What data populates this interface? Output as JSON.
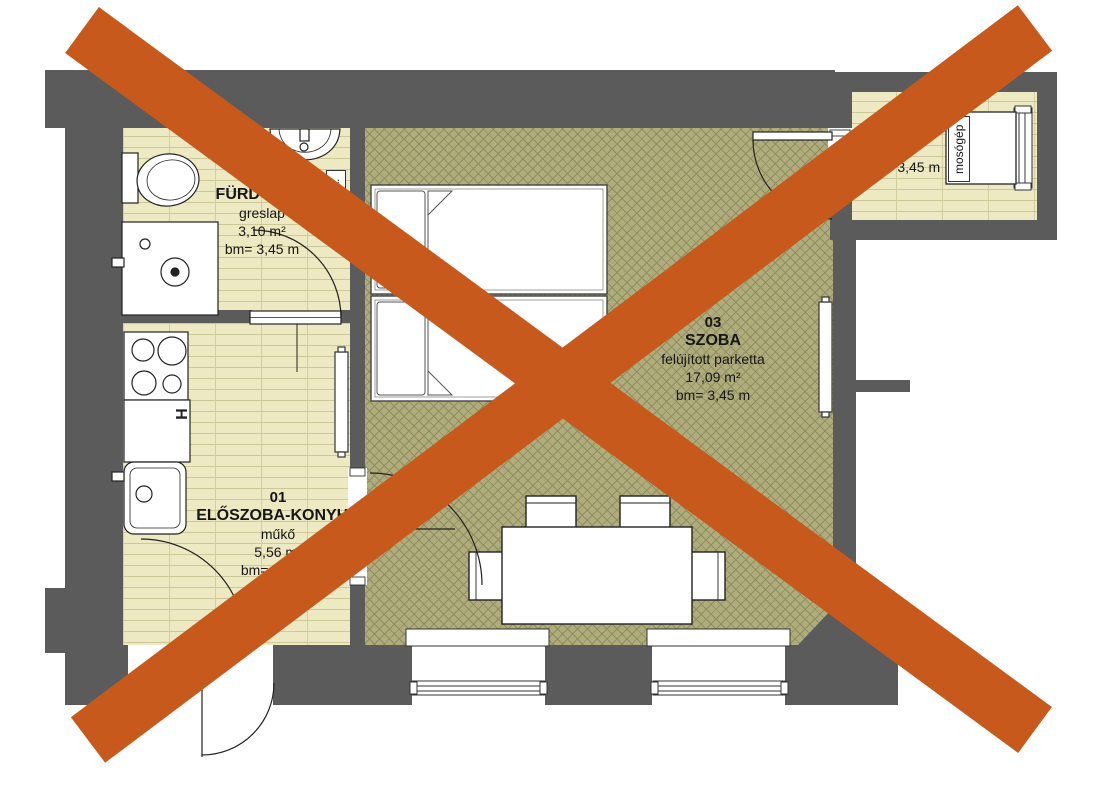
{
  "plan": {
    "rooms": [
      {
        "number": "01",
        "name": "ELŐSZOBA-KONYHA",
        "finish": "műkő",
        "area": "5,56 m²",
        "ceiling": "bm= 3,45 m"
      },
      {
        "number": "02",
        "name": "FÜRDŐ+WC",
        "finish": "greslap",
        "area": "3,10 m²",
        "ceiling": "bm= 3,45 m"
      },
      {
        "number": "03",
        "name": "SZOBA",
        "finish": "felújított parketta",
        "area": "17,09 m²",
        "ceiling": "bm= 3,45 m"
      },
      {
        "number": "04",
        "name": "TÁROLÓ",
        "finish": "",
        "area": "m²",
        "ceiling": "bm= 3,45 m"
      }
    ],
    "annotations": {
      "towel_rail": "törölk.",
      "washing_machine": "mosógép",
      "kitchen_h": "H"
    }
  },
  "colors": {
    "wall": "#5B5B5B",
    "tile": "#EDE9C3",
    "tile_line": "#cdc897",
    "parquet": "#AFAD7C",
    "parquet_line": "#8f8d60",
    "cross": "#C7591D"
  }
}
